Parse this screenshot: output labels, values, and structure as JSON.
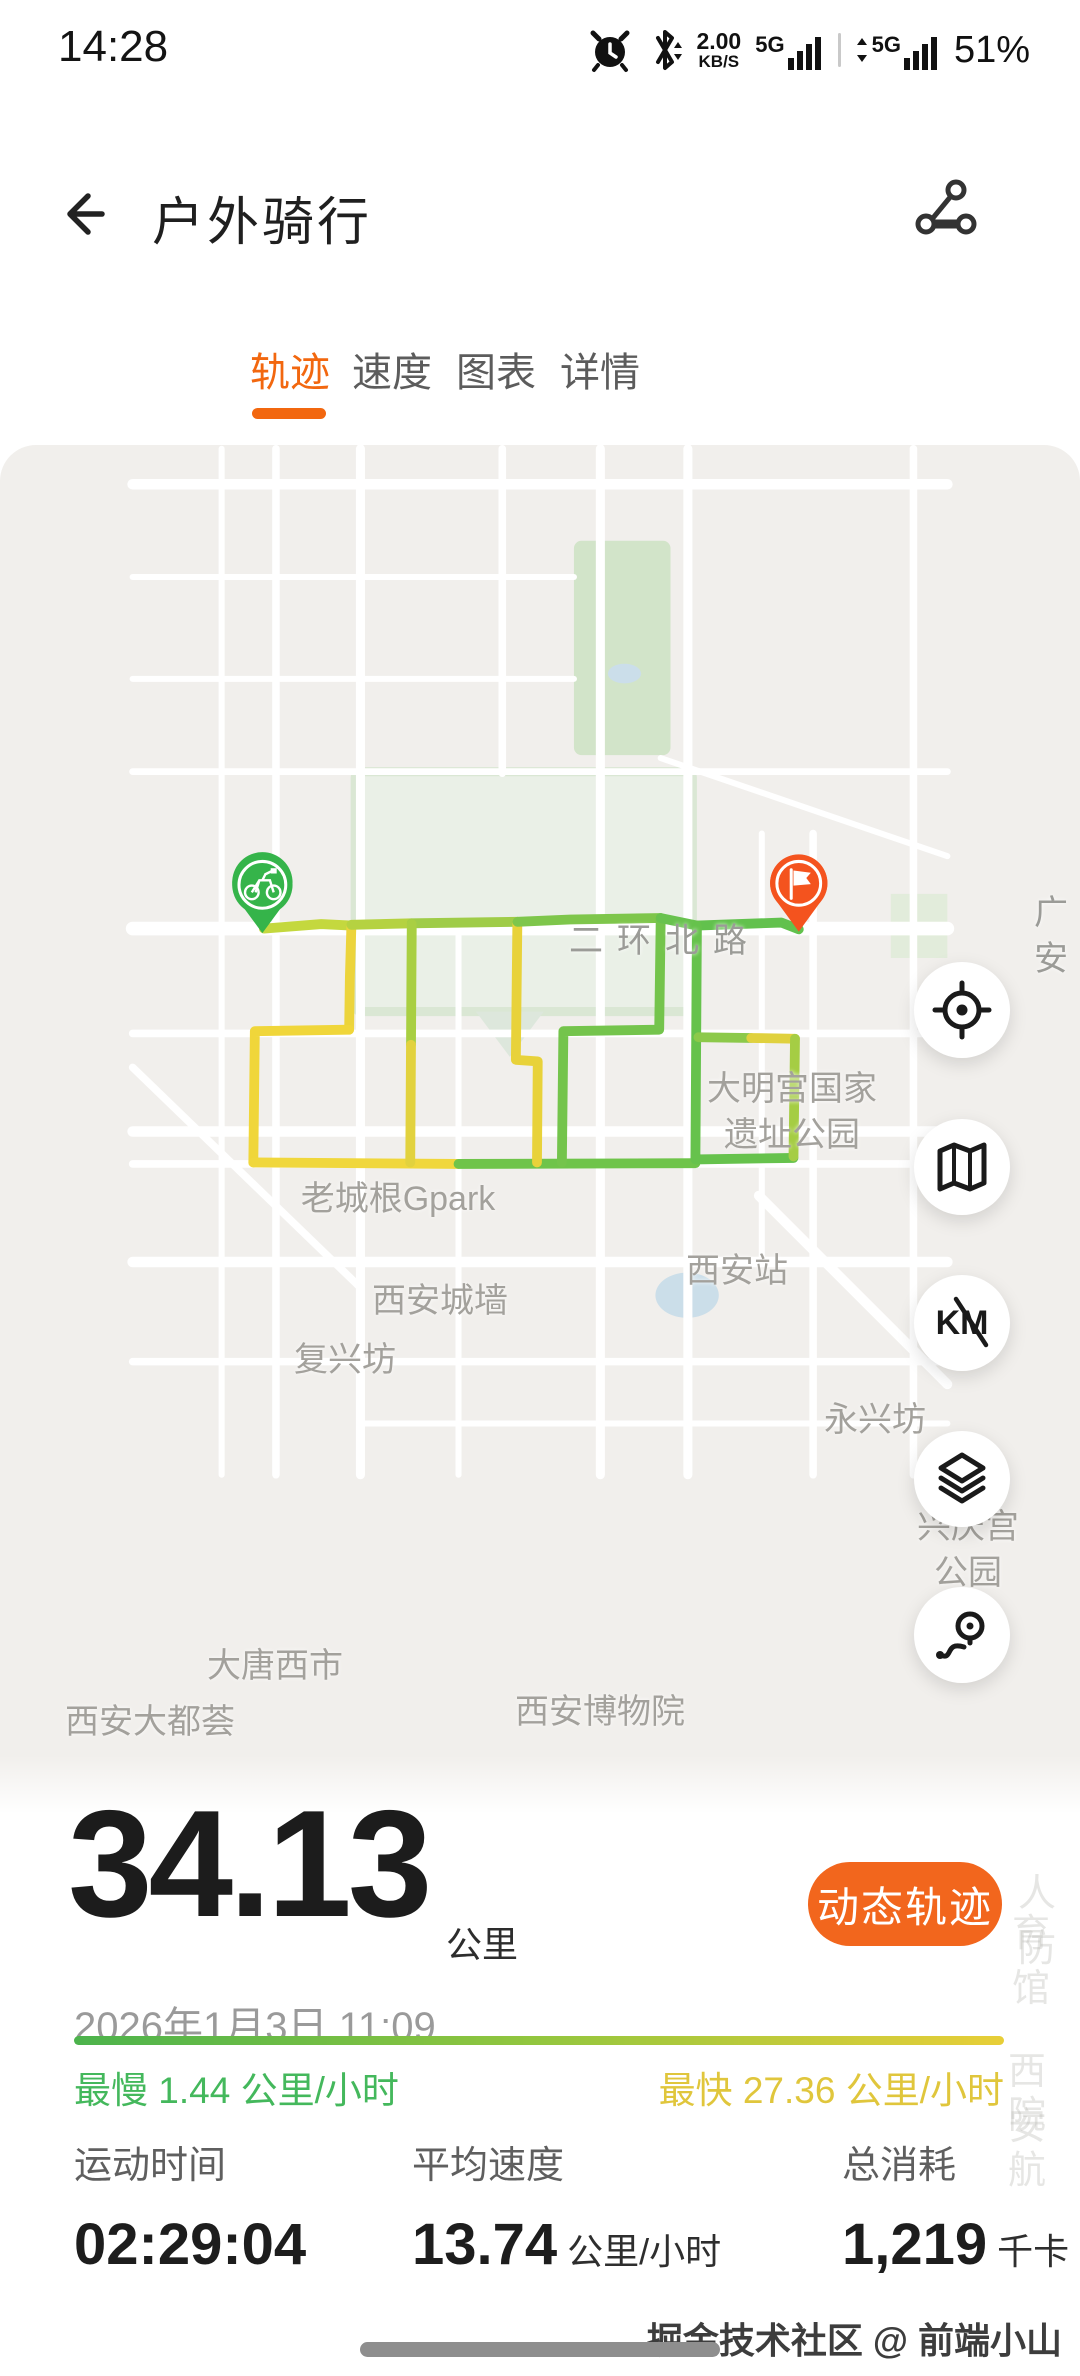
{
  "colors": {
    "accent_orange": "#F2670F",
    "button_orange": "#F2661D",
    "route_yellow": "#F0D63A",
    "route_yellow_green": "#C4D83E",
    "route_green": "#66C24C",
    "slow_green": "#44B85C",
    "fast_yellow": "#E0C63C",
    "start_pin_green": "#35B44A",
    "end_pin_orange": "#F4531E",
    "map_bg": "#F1EFEC"
  },
  "status_bar": {
    "time": "14:28",
    "net_speed": "2.00",
    "net_unit": "KB/S",
    "sim1": "5G",
    "sim2": "5G",
    "battery": "51%"
  },
  "header": {
    "title": "户外骑行"
  },
  "tabs": [
    {
      "label": "轨迹",
      "active": true
    },
    {
      "label": "速度",
      "active": false
    },
    {
      "label": "图表",
      "active": false
    },
    {
      "label": "详情",
      "active": false
    }
  ],
  "map": {
    "labels": [
      {
        "text": "二环北路"
      },
      {
        "text": "广安"
      },
      {
        "text": "大明宫国家\n遗址公园"
      },
      {
        "text": "老城根Gpark"
      },
      {
        "text": "西安站"
      },
      {
        "text": "西安城墙"
      },
      {
        "text": "复兴坊"
      },
      {
        "text": "永兴坊"
      },
      {
        "text": "兴庆宫公园"
      },
      {
        "text": "大唐西市"
      },
      {
        "text": "西安大都荟"
      },
      {
        "text": "西安博物院"
      },
      {
        "text": "大兴善寺"
      },
      {
        "text": "陕西历史博物馆"
      },
      {
        "text": "大慈恩寺"
      },
      {
        "text": "西安文理学\n院高新校区"
      },
      {
        "text": "万达广场"
      },
      {
        "text": "曲江路"
      },
      {
        "text": "西安万象城"
      },
      {
        "text": "曲江秦二世\n陵遗址公园"
      }
    ],
    "attribution": "高德地图",
    "ghost_labels": [
      "人防",
      "育馆",
      "西安",
      "院航"
    ],
    "buttons": [
      {
        "name": "locate"
      },
      {
        "name": "map-mode"
      },
      {
        "name": "km-toggle",
        "label": "KM"
      },
      {
        "name": "layers"
      },
      {
        "name": "route-detail"
      }
    ]
  },
  "summary": {
    "distance": "34.13",
    "distance_unit": "公里",
    "action": "动态轨迹",
    "datetime": "2026年1月3日 11:09",
    "slowest_label": "最慢",
    "slowest_value": "1.44",
    "fastest_label": "最快",
    "fastest_value": "27.36",
    "speed_unit": "公里/小时"
  },
  "metrics": [
    {
      "label": "运动时间",
      "value": "02:29:04",
      "unit": ""
    },
    {
      "label": "平均速度",
      "value": "13.74",
      "unit": "公里/小时"
    },
    {
      "label": "总消耗",
      "value": "1,219",
      "unit": "千卡"
    }
  ],
  "footer": {
    "credit": "掘金技术社区 @ 前端小山"
  }
}
